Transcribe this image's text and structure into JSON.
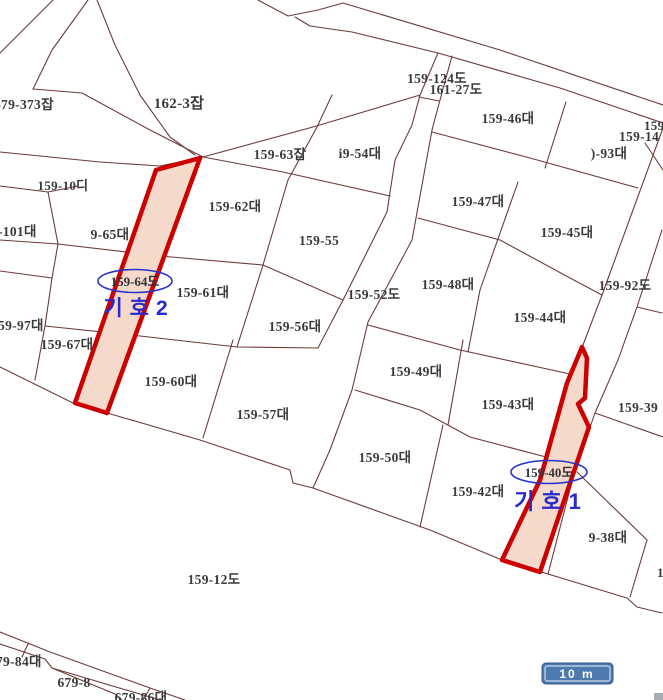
{
  "map": {
    "type": "cadastral-parcel-map",
    "colors": {
      "background": "#ffffff",
      "boundary_line": "#6e3b3b",
      "highlight_stroke": "#cc0000",
      "highlight_fill": "#f5d9ca",
      "annotation_blue": "#2929cc",
      "scalebar_fill": "#4d79ad",
      "scalebar_text": "#ffffff"
    },
    "parcel_labels": [
      {
        "label": "679-373잡"
      },
      {
        "label": "162-3잡"
      },
      {
        "label": "159-124도"
      },
      {
        "label": "161-27도"
      },
      {
        "label": "159-46대"
      },
      {
        "label": "i9-54대"
      },
      {
        "label": "159-63잡"
      },
      {
        "label": ")-93대"
      },
      {
        "label": "159-1"
      },
      {
        "label": "159-14"
      },
      {
        "label": "159-10디"
      },
      {
        "label": "9-65대"
      },
      {
        "label": "-101대"
      },
      {
        "label": "159-62대"
      },
      {
        "label": "159-55"
      },
      {
        "label": "159-61대"
      },
      {
        "label": "159-52도"
      },
      {
        "label": "159-56대"
      },
      {
        "label": "159-97대"
      },
      {
        "label": "159-67대"
      },
      {
        "label": "159-60대"
      },
      {
        "label": "159-57대"
      },
      {
        "label": "159-47대"
      },
      {
        "label": "159-45대"
      },
      {
        "label": "159-48대"
      },
      {
        "label": "159-92도"
      },
      {
        "label": "159-44대"
      },
      {
        "label": "159-49대"
      },
      {
        "label": "159-43대"
      },
      {
        "label": "159-39"
      },
      {
        "label": "159-50대"
      },
      {
        "label": "159-42대"
      },
      {
        "label": "9-38대"
      },
      {
        "label": "159-12도"
      },
      {
        "label": "79-84대"
      },
      {
        "label": "679-8"
      },
      {
        "label": "679-86대"
      },
      {
        "label": "1"
      }
    ],
    "highlight_1": {
      "ellipse_label": "159-40도",
      "marker": "기호1"
    },
    "highlight_2": {
      "ellipse_label": "159-64도",
      "marker": "기호2"
    },
    "scale_bar": {
      "label": "10 m"
    }
  }
}
